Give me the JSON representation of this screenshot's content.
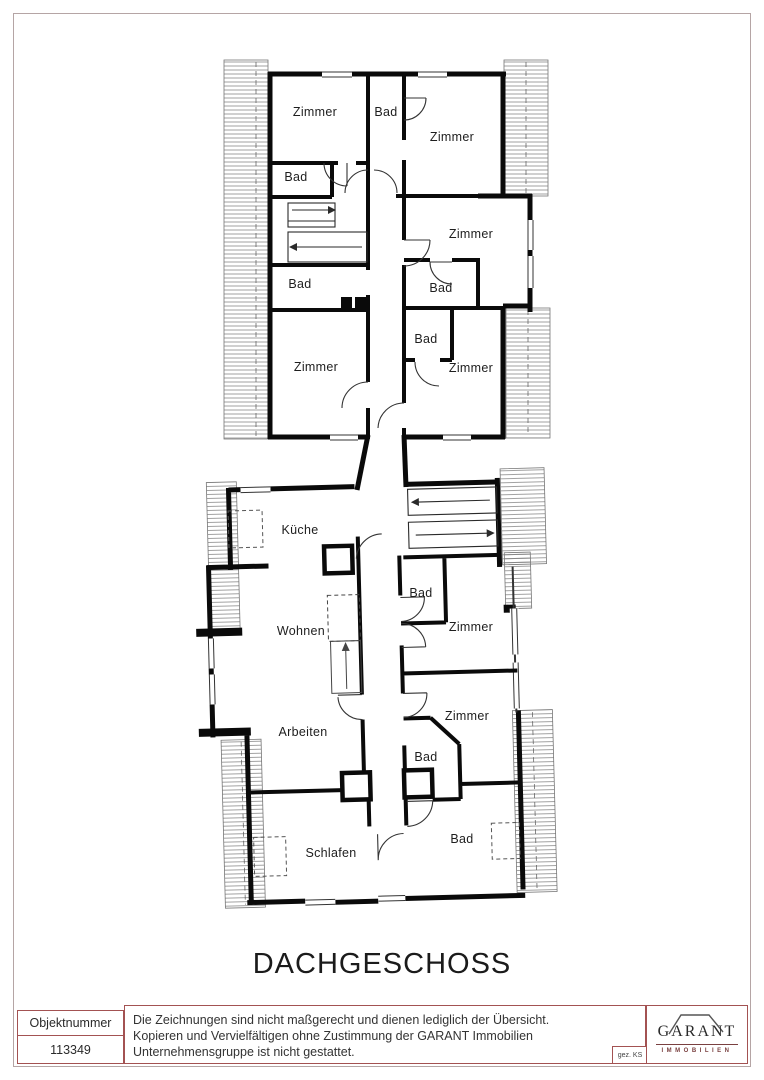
{
  "page": {
    "title": "DACHGESCHOSS"
  },
  "plan": {
    "rooms": [
      {
        "label": "Zimmer"
      },
      {
        "label": "Bad"
      },
      {
        "label": "Zimmer"
      },
      {
        "label": "Bad"
      },
      {
        "label": "Zimmer"
      },
      {
        "label": "Bad"
      },
      {
        "label": "Bad"
      },
      {
        "label": "Bad"
      },
      {
        "label": "Zimmer"
      },
      {
        "label": "Zimmer"
      },
      {
        "label": "Küche"
      },
      {
        "label": "Bad"
      },
      {
        "label": "Zimmer"
      },
      {
        "label": "Wohnen"
      },
      {
        "label": "Zimmer"
      },
      {
        "label": "Arbeiten"
      },
      {
        "label": "Bad"
      },
      {
        "label": "Schlafen"
      },
      {
        "label": "Bad"
      }
    ]
  },
  "footer": {
    "object_number_label": "Objektnummer",
    "object_number_value": "113349",
    "disclaimer_lines": [
      "Die Zeichnungen sind nicht maßgerecht und dienen lediglich der Übersicht.",
      "Kopieren und Vervielfältigen ohne Zustimmung der GARANT Immobilien",
      "Unternehmensgruppe ist nicht gestattet."
    ],
    "signed_label": "gez. KS",
    "logo_name": "GARANT",
    "logo_subtitle": "IMMOBILIEN"
  },
  "colors": {
    "wall": "#0a0a0a",
    "footer_border": "#a35252",
    "page_border": "#b5a5a5",
    "logo_text": "#2a2a2a",
    "logo_accent": "#7a4040"
  }
}
